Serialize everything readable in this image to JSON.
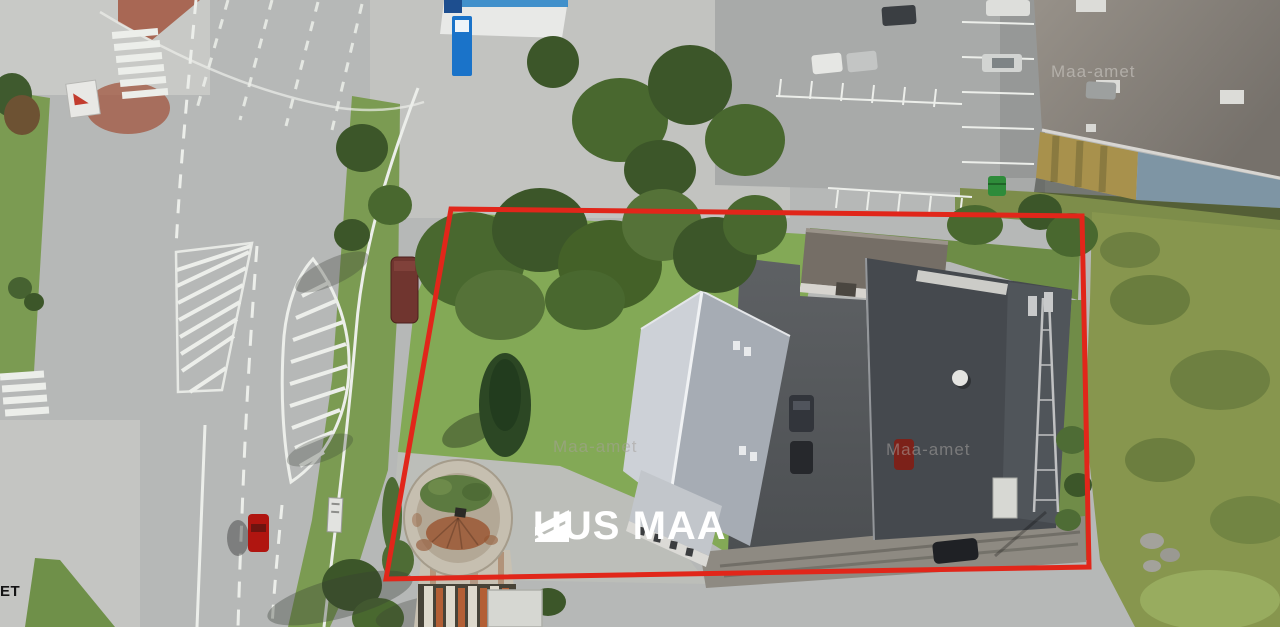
{
  "branding": {
    "logo_text": "UUS MAA",
    "logo_color": "#ffffff"
  },
  "watermark": {
    "text": "Maa-amet",
    "corner_fragment": "ET"
  },
  "boundary": {
    "color": "#e1261a",
    "description": "red outline of listed property"
  },
  "scene": {
    "type": "aerial orthophoto of a property with road, water tower, house, warehouse and parking lots",
    "palette": {
      "asphalt": "#b6b8b7",
      "pavement_light": "#c6c7c4",
      "lawn": "#83a956",
      "grass_strip": "#7b9b52",
      "rough_grass": "#87964e",
      "tree_dark": "#3c5629",
      "house_roof_light": "#cdd1d7",
      "house_roof_dark": "#a6acb4",
      "warehouse_roof": "#45494e",
      "yard_asphalt": "#55585b",
      "gravel": "#8e8a82",
      "road_marking": "#eceeea",
      "brick_island": "#a2563f",
      "kiosk_blue": "#1a73c9",
      "wall_yellow": "#a8914c",
      "wall_blue": "#7e95a4",
      "bus_shelter": "#70352f",
      "red_car": "#b01510",
      "tower_body": "#c6bfb0",
      "tower_rust": "#9c5c3a",
      "dumpster_green": "#2e8b3a",
      "big_roof": "#8a847d"
    }
  }
}
